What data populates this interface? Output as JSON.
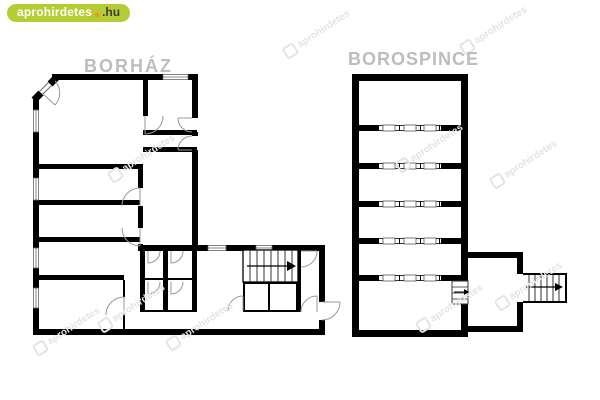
{
  "logo": {
    "brand": "aprohirdetes",
    "tld": ".hu",
    "pill_color": "#b5cc33",
    "dot_color": "#f7941d"
  },
  "plans": {
    "left": {
      "title": "BORHÁZ"
    },
    "right": {
      "title": "BOROSPINCE"
    }
  },
  "watermark": {
    "text": "aprohirdetes"
  },
  "colors": {
    "background": "#ffffff",
    "walls": "#000000",
    "titles": "#bdbdbd",
    "door_arcs": "#999999"
  }
}
